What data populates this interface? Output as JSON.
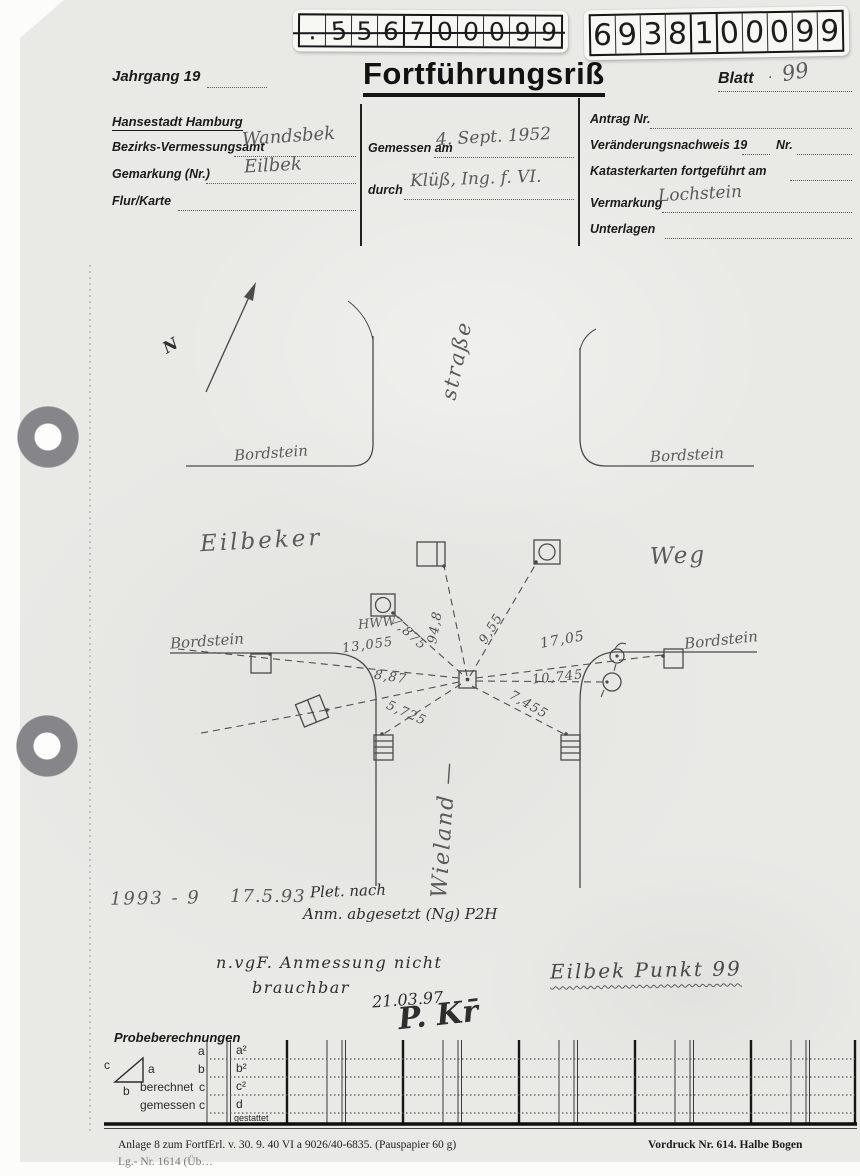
{
  "stickers": {
    "left_digits": [
      ".",
      "5",
      "5",
      "6",
      "7",
      "0",
      "0",
      "0",
      "9",
      "9"
    ],
    "right_digits": [
      "6",
      "9",
      "3",
      "8",
      "1",
      "0",
      "0",
      "0",
      "9",
      "9"
    ]
  },
  "header": {
    "jahrgang": "Jahrgang 19",
    "title": "Fortführungsriß",
    "blatt": "Blatt",
    "blatt_sep": "·",
    "blatt_value": "99"
  },
  "form": {
    "city": "Hansestadt Hamburg",
    "bva_label": "Bezirks-Vermessungsamt",
    "bva_value": "Wandsbek",
    "gemarkung_label": "Gemarkung (Nr.)",
    "gemarkung_value": "Eilbek",
    "flur_label": "Flur/Karte",
    "gemessen_label": "Gemessen am",
    "gemessen_value": "4. Sept. 1952",
    "durch_label": "durch",
    "durch_value": "Klüß, Ing. f. VI.",
    "antrag_label": "Antrag Nr.",
    "vn_label": "Veränderungsnachweis 19",
    "vn_nr_label": "Nr.",
    "kk_label": "Katasterkarten fortgeführt am",
    "vermarkung_label": "Vermarkung",
    "vermarkung_value": "Lochstein",
    "unterlagen_label": "Unterlagen"
  },
  "sketch": {
    "north": "N",
    "strasse": "straße",
    "eilbeker": "Eilbeker",
    "weg": "Weg",
    "wieland": "Wieland —",
    "curb": "Bordstein",
    "hww": "HWW",
    "m94": "94,8",
    "m955": "9,55",
    "m7875": "7,875",
    "m13055": "13,055",
    "m887": "8,87",
    "m5725": "5,725",
    "m1705": "17,05",
    "m10745": "10,745",
    "m7455": "7,455"
  },
  "notes": {
    "year": "1993 - 9",
    "date": "17.5.93",
    "note_a": "Plet. nach",
    "note_b": "Anm. abgesetzt (Ng)  P2H",
    "nvgf_1": "n.vgF.  Anmessung nicht",
    "nvgf_2": "brauchbar",
    "nvgf_date": "21.03.97",
    "signature": "P. Kr̄",
    "point": "Eilbek Punkt 99"
  },
  "probe": {
    "heading": "Probeberechnungen",
    "tri_a": "a",
    "tri_b": "b",
    "tri_c": "c",
    "row_a": "a",
    "row_b": "b",
    "berechnet": "berechnet",
    "gemessen": "gemessen",
    "row_c1": "c",
    "row_c2": "c",
    "f_a2": "a²",
    "f_b2": "b²",
    "f_c2": "c²",
    "f_d": "d",
    "gestattet": "gestattet"
  },
  "footer": {
    "left": "Anlage 8 zum FortfErl. v. 30. 9. 40  VI a 9026/40-6835.  (Pauspapier 60 g)",
    "right": "Vordruck Nr. 614.  Halbe Bogen",
    "cut": "Lg.- Nr. 1614  (Üb…"
  }
}
